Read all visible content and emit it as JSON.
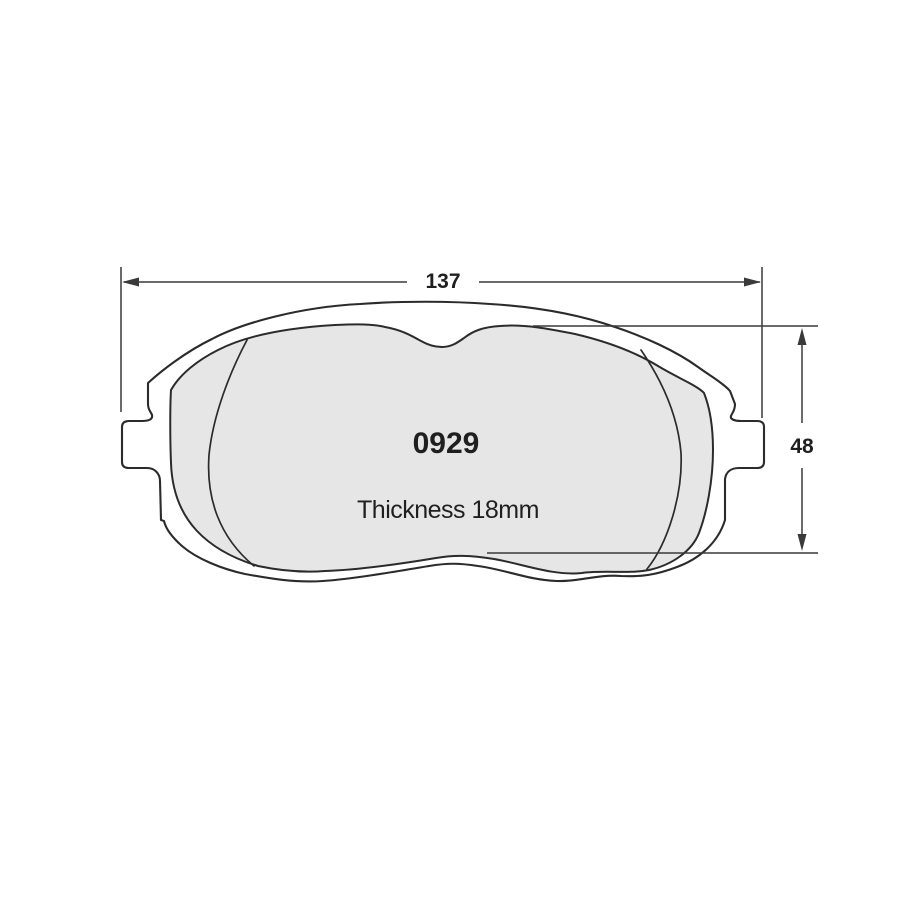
{
  "colors": {
    "line": "#2b2b2b",
    "dimension_line": "#3a3a3a",
    "friction_fill": "#e6e6e6",
    "plate_fill": "#ffffff",
    "background": "#ffffff",
    "text": "#1f1f1f"
  },
  "drawing": {
    "part_number": "0929",
    "thickness_label": "Thickness 18mm",
    "dimensions": {
      "width": {
        "value": "137"
      },
      "height": {
        "value": "48"
      }
    }
  }
}
